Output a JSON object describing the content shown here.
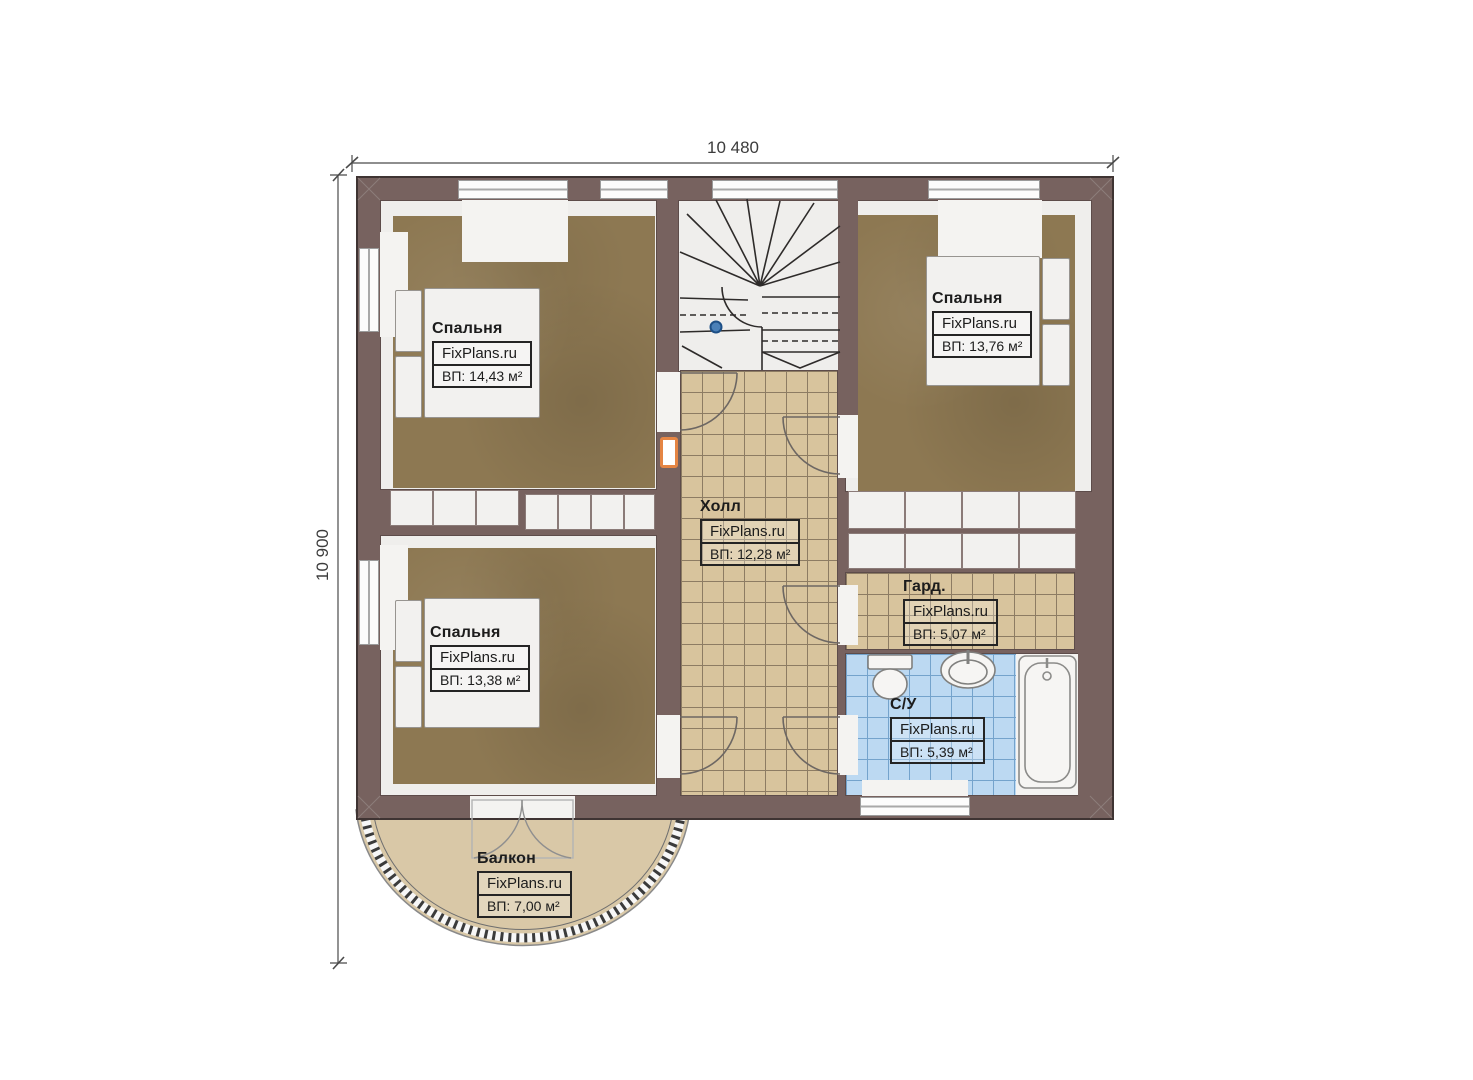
{
  "brand": "FixPlans.ru",
  "dimensions": {
    "top": "10 480",
    "left": "10 900"
  },
  "rooms": {
    "bedroom_top_left": {
      "name": "Спальня",
      "area": "ВП: 14,43 м²"
    },
    "bedroom_top_right": {
      "name": "Спальня",
      "area": "ВП: 13,76 м²"
    },
    "bedroom_bottom_left": {
      "name": "Спальня",
      "area": "ВП: 13,38 м²"
    },
    "hall": {
      "name": "Холл",
      "area": "ВП: 12,28 м²"
    },
    "wardrobe": {
      "name": "Гард.",
      "area": "ВП: 5,07 м²"
    },
    "bathroom": {
      "name": "С/У",
      "area": "ВП: 5,39 м²"
    },
    "balcony": {
      "name": "Балкон",
      "area": "ВП: 7,00 м²"
    }
  },
  "colors": {
    "wall": "#77625f",
    "carpet": "#8d7852",
    "tile_beige": "#d8c49d",
    "tile_blue": "#bcd9f2",
    "balcony": "#d9c8a7",
    "accent_orange": "#e58544",
    "marker_blue": "#4a80b8"
  }
}
